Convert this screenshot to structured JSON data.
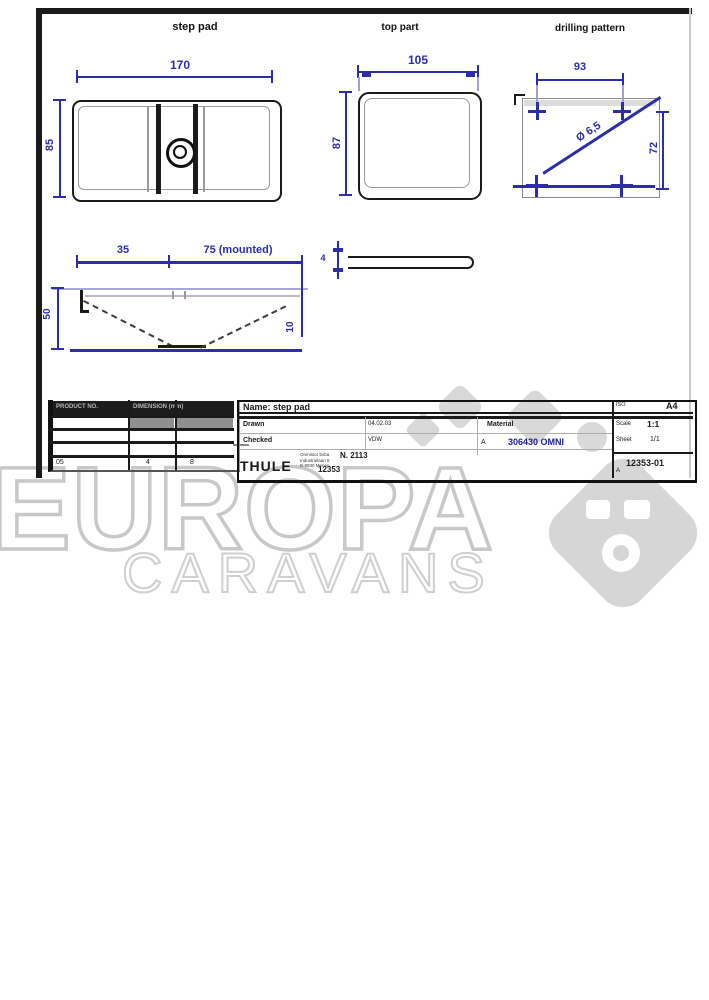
{
  "watermark": {
    "title": "EUROPA",
    "subtitle": "CARAVANS",
    "color": "#c8c8c8"
  },
  "drawing": {
    "views": {
      "main": {
        "label": "step pad",
        "width_dim": "170",
        "height_dim": "85"
      },
      "top": {
        "label": "top part",
        "width_dim": "105",
        "height_dim": "87"
      },
      "drill": {
        "label": "drilling pattern",
        "width_dim": "93",
        "height_dim": "72",
        "hole_dim": "Ø 6,5"
      }
    },
    "section": {
      "dim_left": "35",
      "dim_right": "75 (mounted)",
      "height_dim": "50",
      "depth_dim": "10",
      "thickness_dim": "4"
    },
    "parts_table": {
      "header_left": "PRODUCT NO.",
      "header_right": "DIMENSION (mm)",
      "row_values": [
        "05",
        "4",
        "8"
      ]
    },
    "title_block": {
      "name_row": "Name: step pad",
      "drawn_label": "Drawn",
      "checked_label": "Checked",
      "date_value": "04.02.03",
      "name_value": "VDW",
      "material_label": "Material",
      "part_prefix": "A",
      "part_number": "306430 OMNI",
      "part_number_color": "#1e1e96",
      "brand": "THULE",
      "address_lines": [
        "Omnistor bvba",
        "Industrielaan 5",
        "B-8930 Menen"
      ],
      "code_top": "N. 2113",
      "code_bottom": "12353",
      "standard": "ISO",
      "paper_size": "A4",
      "scale_label": "Scale",
      "scale_value": "1:1",
      "sheet_label": "Sheet",
      "sheet_value": "1/1",
      "drawing_number": "12353-01",
      "revision": "A"
    },
    "colors": {
      "dimension": "#2d2da8",
      "line": "#1a1a1a"
    }
  }
}
